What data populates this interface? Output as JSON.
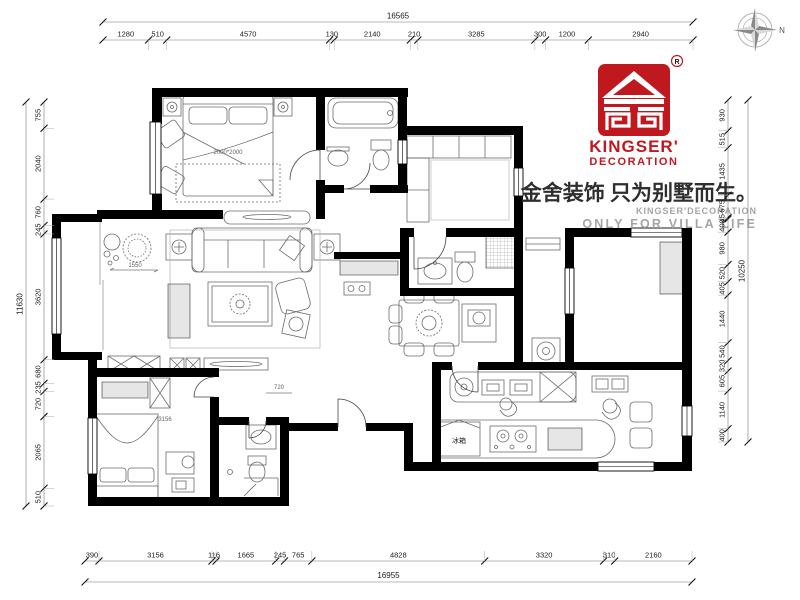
{
  "branding": {
    "registered_mark": "R",
    "brand_name_line1": "KINGSER'",
    "brand_name_line2": "DECORATION",
    "slogan_cn": "金舍装饰 只为别墅而生。",
    "sub_line1": "KINGSER'DECORATION",
    "sub_line2": "ONLY FOR VILLA LIFE",
    "brand_red": "#c0181f",
    "gray_text": "#a5a5a5"
  },
  "compass": {
    "label": "N"
  },
  "dimensions": {
    "top": {
      "total": "16565",
      "segments": [
        1280,
        510,
        4570,
        130,
        2140,
        210,
        3285,
        300,
        1200,
        2940
      ]
    },
    "bottom": {
      "total": "16955",
      "segments": [
        390,
        3156,
        116,
        1665,
        245,
        765,
        4828,
        3320,
        310,
        2160
      ]
    },
    "left": {
      "total": "11630",
      "segments": [
        755,
        2040,
        760,
        245,
        3620,
        680,
        235,
        720,
        2065,
        510
      ]
    },
    "right": {
      "total": "10250",
      "segments": [
        930,
        515,
        1435,
        675,
        45,
        400,
        980,
        520,
        405,
        1440,
        540,
        320,
        605,
        1140,
        400
      ]
    }
  },
  "plan_labels": {
    "master_bed_size": "2000*2000",
    "balcony_width": "1550",
    "bedroom_width": "3156",
    "passage_width": "720",
    "fridge": "冰箱"
  }
}
